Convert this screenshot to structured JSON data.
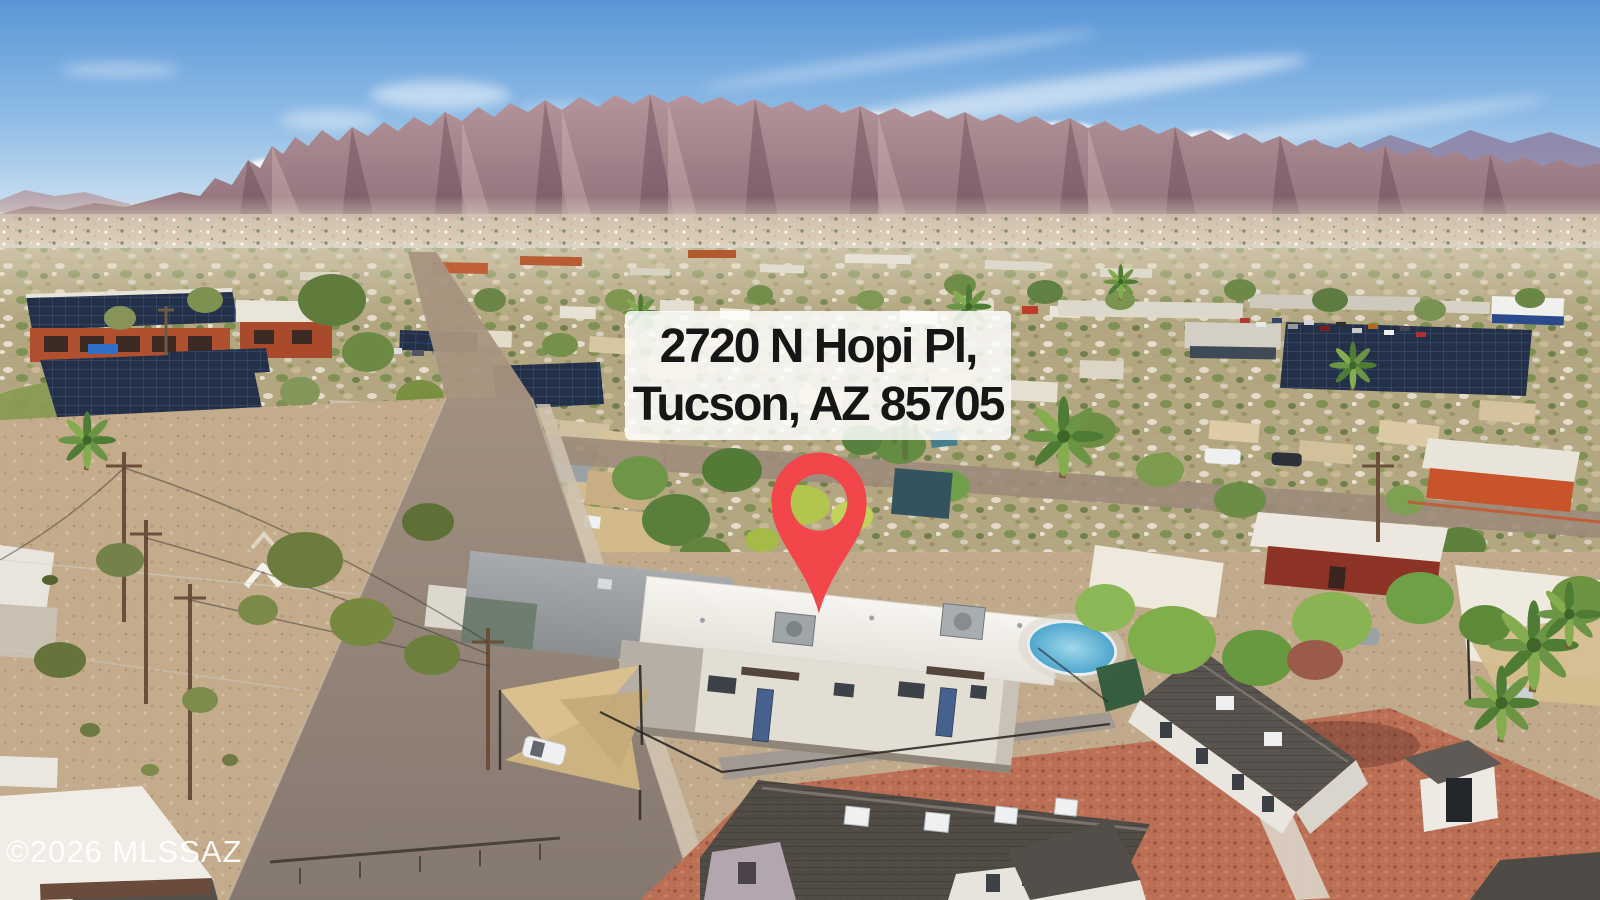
{
  "address_overlay": {
    "line1": "2720 N Hopi Pl,",
    "line2": "Tucson, AZ 85705",
    "background": "#ffffff",
    "text_color": "#161616"
  },
  "map_pin": {
    "icon": "location-pin",
    "color": "#f2464a"
  },
  "watermark": {
    "text": "©2026 MLSSAZ",
    "color": "#ffffff"
  },
  "palette": {
    "sky_top": "#5a96d7",
    "sky_horizon": "#e8eff3",
    "mountains": "#9d7d85",
    "mountains_far": "#8d80a2",
    "haze": "#e2d4c4",
    "vegetation": "#6f9548",
    "desert_ground": "#c7b091",
    "asphalt": "#96857a",
    "red_gravel": "#bd7256",
    "subject_roof": "#f3f1ec",
    "solar_panels": "#243048",
    "pool_water": "#57b0d4",
    "shade_sail": "#d9c08e"
  }
}
